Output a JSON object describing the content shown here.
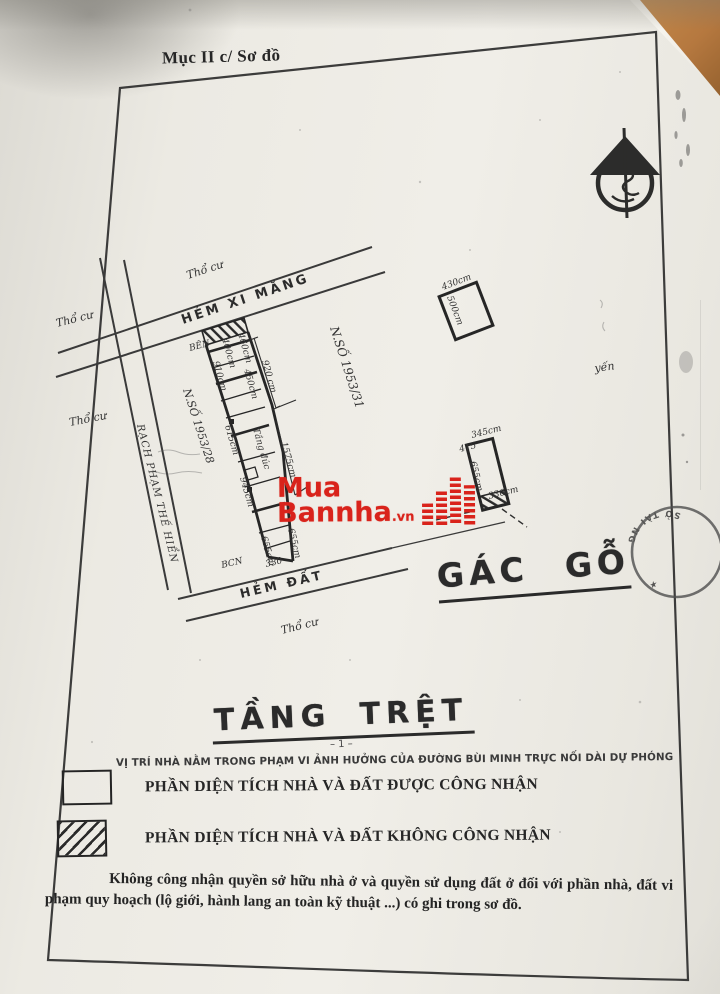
{
  "section_label": "Mục II c/ Sơ đồ",
  "floor_title": "TẦNG TRỆT",
  "floor_title_mark": "– 1 –",
  "mezzanine_label": "GÁC GỖ",
  "note_line": "VỊ TRÍ NHÀ NẰM TRONG PHẠM VI ẢNH HƯỞNG CỦA ĐƯỜNG BÙI MINH TRỰC NỐI DÀI DỰ PHÓNG",
  "legend": {
    "item1": "PHẦN DIỆN TÍCH NHÀ VÀ ĐẤT ĐƯỢC CÔNG NHẬN",
    "item2": "PHẦN DIỆN TÍCH NHÀ VÀ ĐẤT KHÔNG CÔNG NHẬN"
  },
  "footnote": "Không công nhận quyền sở hữu nhà ở và quyền sử dụng đất ở đối với phần nhà, đất vi phạm quy hoạch (lộ giới, hành lang an toàn kỹ thuật ...) có ghi trong sơ đồ.",
  "watermark": {
    "line1": "Mua",
    "line2": "Bannha",
    "tld": ".vn",
    "color": "#d9231b"
  },
  "stamp": {
    "arc_text": "SỞ TÀI NG"
  },
  "colors": {
    "logo_red": "#d9231b",
    "paper": "#edebe4",
    "ink": "#2d2d2d",
    "corner_orange": "#b5783f"
  },
  "plan": {
    "street_cement": "HẺM  XI  MĂNG",
    "street_dirt": "HẺM  ĐẤT",
    "canal": "RẠCH PHẠM THẾ HIỂN",
    "tho_cu": "Thổ cư",
    "parcel_right": "N.SỐ 1953/31",
    "parcel_left": "N.SỐ 1953/28",
    "dim_910": "910cm",
    "dim_615": "615cm",
    "dim_945": "945cm",
    "dim_655a": "655cm",
    "dim_655b": "655cm",
    "dim_330": "330",
    "dim_920": "920 cm",
    "dim_1575": "1575cm",
    "dim_460": "460cm",
    "dim_450": "450cm",
    "dim_400": "400cm",
    "note_ben": "BÊN",
    "note_bcn": "BCN",
    "note_tang": "Tầng đúc",
    "note_yen": "yến",
    "b1_w": "430cm",
    "b1_h": "500cm",
    "b2_w": "345cm",
    "b2_h": "655cm",
    "b2_b": "330cm",
    "b2_x": "415"
  }
}
